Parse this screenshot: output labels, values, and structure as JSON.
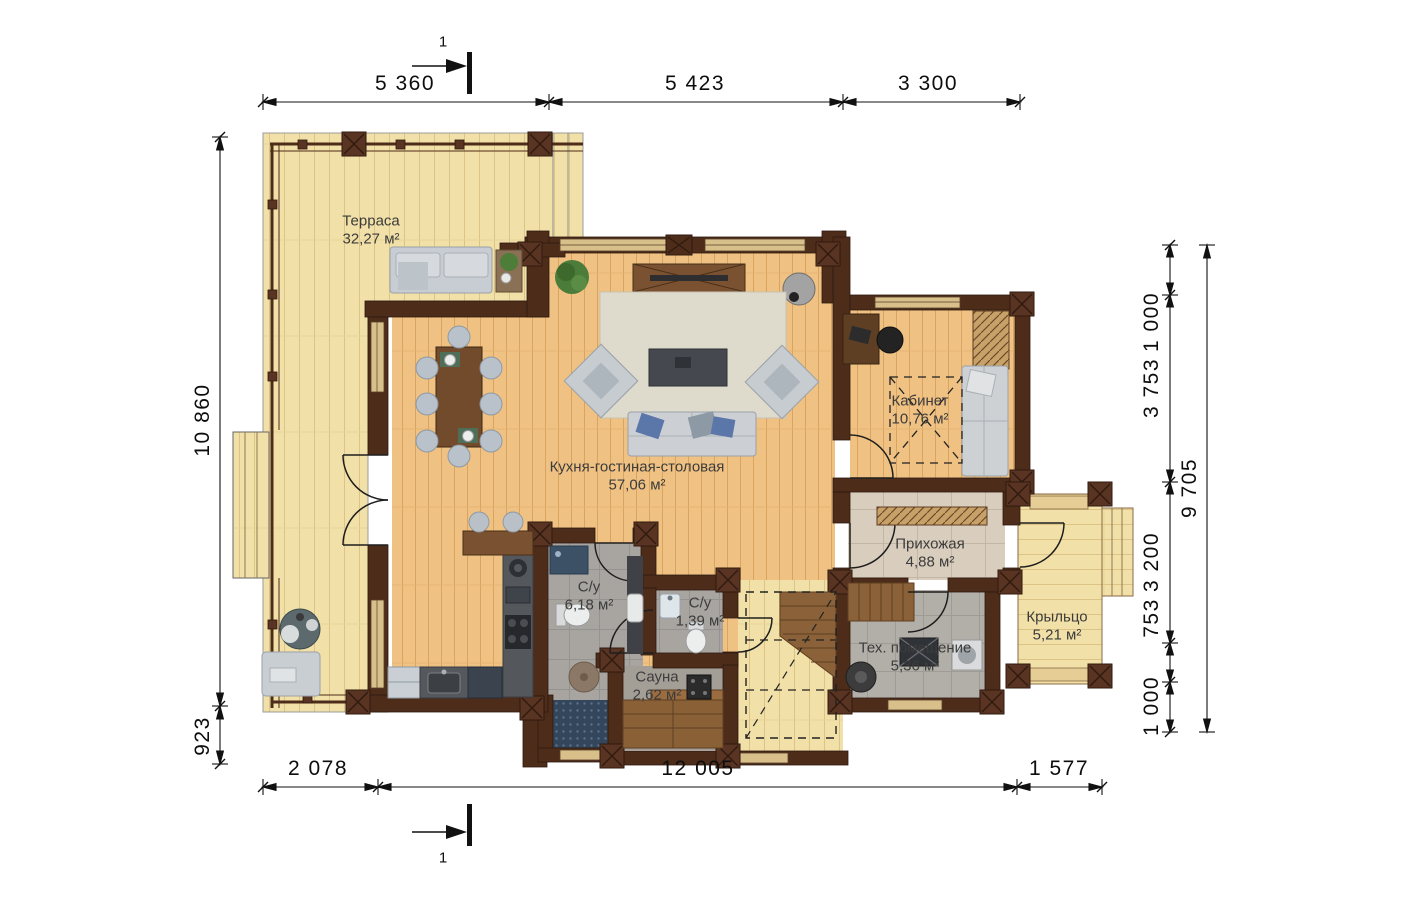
{
  "plan": {
    "rooms": [
      {
        "id": "terrace",
        "name": "Терраса",
        "area": "32,27 м²"
      },
      {
        "id": "kitchen-living",
        "name": "Кухня-гостиная-столовая",
        "area": "57,06 м²"
      },
      {
        "id": "office",
        "name": "Кабинет",
        "area": "10,76 м²"
      },
      {
        "id": "hallway",
        "name": "Прихожая",
        "area": "4,88 м²"
      },
      {
        "id": "bathroom",
        "name": "С/у",
        "area": "6,18 м²"
      },
      {
        "id": "wc",
        "name": "С/у",
        "area": "1,39 м²"
      },
      {
        "id": "sauna",
        "name": "Сауна",
        "area": "2,62 м²"
      },
      {
        "id": "utility",
        "name": "Тех. помещение",
        "area": "5,36 м²"
      },
      {
        "id": "porch",
        "name": "Крыльцо",
        "area": "5,21 м²"
      }
    ],
    "dimensions": {
      "top": [
        "5 360",
        "5 423",
        "3 300"
      ],
      "bottom": [
        "2 078",
        "12 005",
        "1 577"
      ],
      "left": [
        "10 860",
        "923"
      ],
      "right": [
        "1 000",
        "3 753",
        "3 200",
        "753",
        "1 000"
      ],
      "right_total": "9 705"
    },
    "section_mark": "1"
  }
}
